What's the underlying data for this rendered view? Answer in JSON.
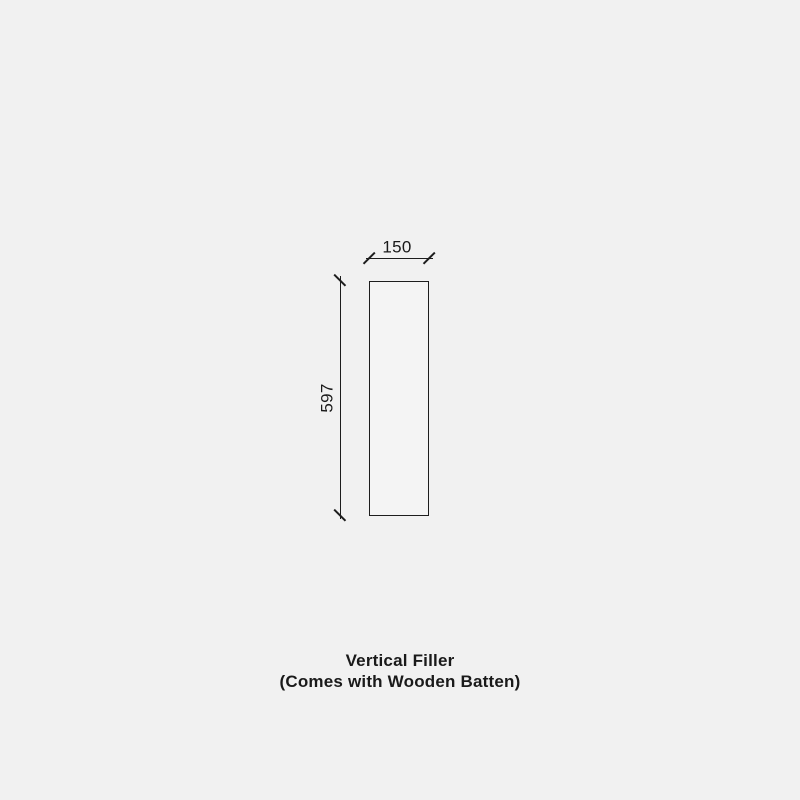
{
  "colors": {
    "background": "#f1f1f1",
    "panel_fill": "#f4f4f4",
    "line_color": "#1d1d1d",
    "text_color": "#1a1a1a"
  },
  "diagram": {
    "width_dimension": "150",
    "height_dimension": "597"
  },
  "caption": {
    "title": "Vertical Filler",
    "subtitle": "(Comes with Wooden Batten)"
  }
}
